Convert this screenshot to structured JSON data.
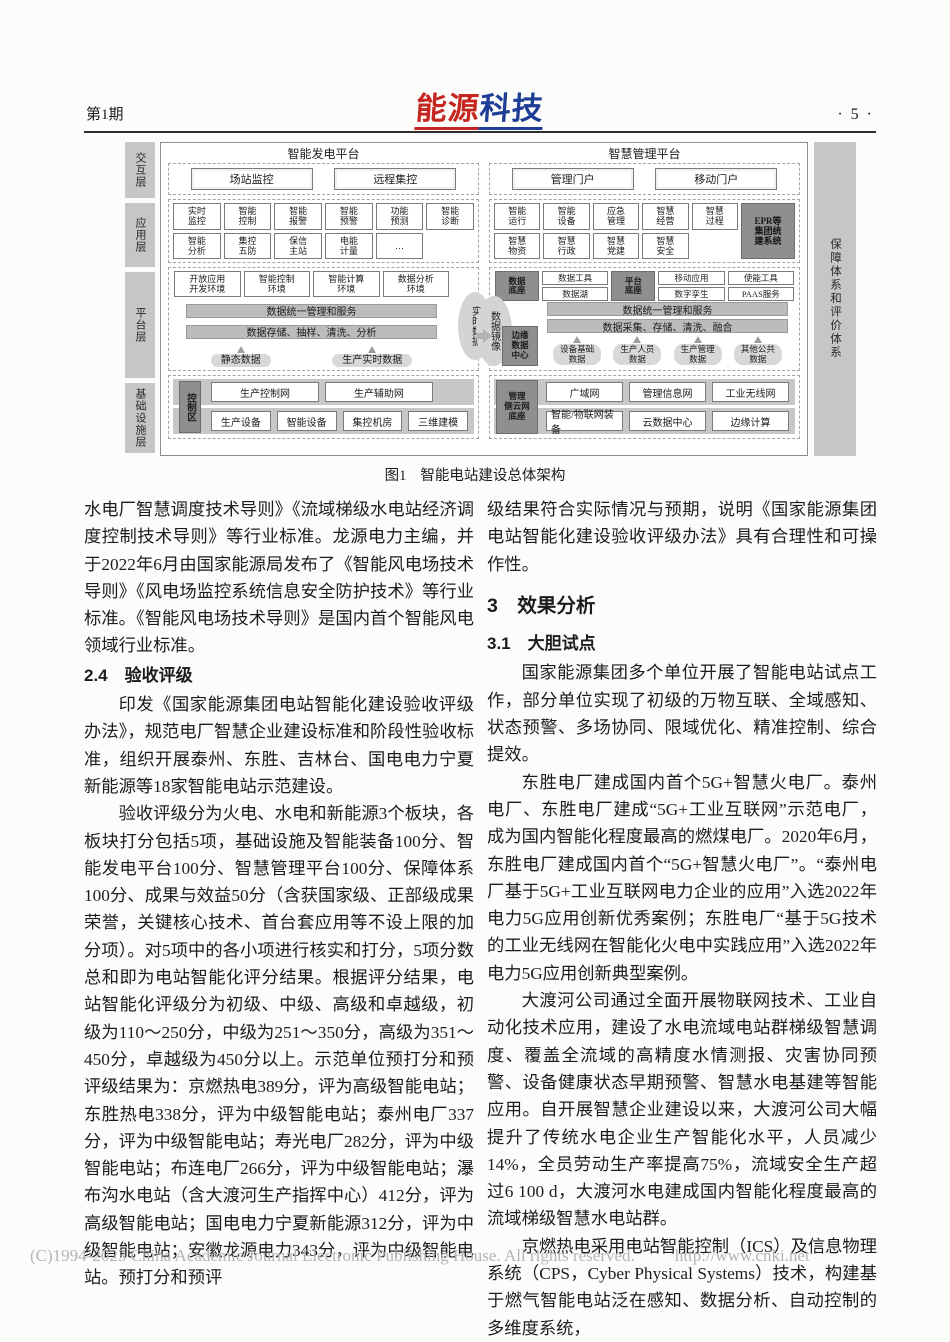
{
  "header": {
    "issue": "第1期",
    "logo_red": "能源",
    "logo_blue": "科技",
    "page_number": "· 5 ·"
  },
  "figure": {
    "caption_label": "图1",
    "caption_title": "智能电站建设总体架构",
    "layers": [
      "交互层",
      "应用层",
      "平台层",
      "基础设施层"
    ],
    "right_system_label": "保障体系和评价体系",
    "gen_platform_title": "智能发电平台",
    "mgmt_platform_title": "智慧管理平台",
    "interaction": {
      "gen": [
        "场站监控",
        "远程集控"
      ],
      "mgmt": [
        "管理门户",
        "移动门户"
      ]
    },
    "application": {
      "gen_row1": [
        "实时\n监控",
        "智能\n控制",
        "智能\n报警",
        "智能\n预警",
        "功能\n预测",
        "智能\n诊断"
      ],
      "gen_row2": [
        "智能\n分析",
        "集控\n五防",
        "保信\n主站",
        "电能\n计量",
        "…"
      ],
      "mgmt_row1": [
        "智能\n运行",
        "智能\n设备",
        "应急\n管理",
        "智慧\n经营",
        "智慧\n过程"
      ],
      "mgmt_row2": [
        "智慧\n物资",
        "智慧\n行政",
        "智慧\n党建",
        "智慧\n安全"
      ],
      "mgmt_epr": "EPR等\n集团统\n建系统"
    },
    "platform": {
      "gen_envs": [
        "开放应用\n开发环境",
        "智能控制\n环境",
        "智能计算\n环境",
        "数据分析\n环境"
      ],
      "gen_bar1": "数据统一管理和服务",
      "gen_bar2": "数据存储、抽样、清洗、分析",
      "gen_sources": [
        "静态数据",
        "生产实时数据"
      ],
      "realtime_data": "实时数据",
      "data_mirror": "数据镜像",
      "edge_center": "边缘\n数据\n中心",
      "mgmt_dark1": "数据\n底座",
      "mgmt_stack1": [
        "数据工具",
        "数据湖"
      ],
      "mgmt_dark2": "平台\n底座",
      "mgmt_stack2": [
        "移动应用",
        "数字孪生"
      ],
      "mgmt_stack3": [
        "使能工具",
        "PAAS服务"
      ],
      "mgmt_bar1": "数据统一管理和服务",
      "mgmt_bar2": "数据采集、存储、清洗、融合",
      "mgmt_sources": [
        "设备基础\n数据",
        "生产人员\n数据",
        "生产管理\n数据",
        "其他公共\n数据"
      ]
    },
    "infrastructure": {
      "gen_zone": "控制区",
      "gen_row1": [
        "生产控制网",
        "生产辅助网"
      ],
      "gen_row2": [
        "生产设备",
        "智能设备",
        "集控机房",
        "三维建模"
      ],
      "mgmt_zone": "管理\n侧云网\n底座",
      "mgmt_row1": [
        "广域网",
        "管理信息网",
        "工业无线网"
      ],
      "mgmt_row2": [
        "智能/物联网装备",
        "云数据中心",
        "边缘计算"
      ]
    }
  },
  "left_column": {
    "p1": "水电厂智慧调度技术导则》《流域梯级水电站经济调度控制技术导则》等行业标准。龙源电力主编，并于2022年6月由国家能源局发布了《智能风电场技术导则》《风电场监控系统信息安全防护技术》等行业标准。《智能风电场技术导则》是国内首个智能风电领域行业标准。",
    "h24": "2.4　验收评级",
    "p2": "印发《国家能源集团电站智能化建设验收评级办法》，规范电厂智慧企业建设标准和阶段性验收标准，组织开展泰州、东胜、吉林台、国电电力宁夏新能源等18家智能电站示范建设。",
    "p3": "验收评级分为火电、水电和新能源3个板块，各板块打分包括5项，基础设施及智能装备100分、智能发电平台100分、智慧管理平台100分、保障体系100分、成果与效益50分（含获国家级、正部级成果荣誉，关键核心技术、首台套应用等不设上限的加分项）。对5项中的各小项进行核实和打分，5项分数总和即为电站智能化评分结果。根据评分结果，电站智能化评级分为初级、中级、高级和卓越级，初级为110～250分，中级为251～350分，高级为351～450分，卓越级为450分以上。示范单位预打分和预评级结果为：京燃热电389分，评为高级智能电站；东胜热电338分，评为中级智能电站；泰州电厂337分，评为中级智能电站；寿光电厂282分，评为中级智能电站；布连电厂266分，评为中级智能电站；瀑布沟水电站（含大渡河生产指挥中心）412分，评为高级智能电站；国电电力宁夏新能源312分，评为中级智能电站；安徽龙源电力343分，评为中级智能电站。预打分和预评"
  },
  "right_column": {
    "p1": "级结果符合实际情况与预期，说明《国家能源集团电站智能化建设验收评级办法》具有合理性和可操作性。",
    "h3": "3　效果分析",
    "h31": "3.1　大胆试点",
    "p2": "国家能源集团多个单位开展了智能电站试点工作，部分单位实现了初级的万物互联、全域感知、状态预警、多场协同、限域优化、精准控制、综合提效。",
    "p3": "东胜电厂建成国内首个5G+智慧火电厂。泰州电厂、东胜电厂建成“5G+工业互联网”示范电厂，成为国内智能化程度最高的燃煤电厂。2020年6月，东胜电厂建成国内首个“5G+智慧火电厂”。“泰州电厂基于5G+工业互联网电力企业的应用”入选2022年电力5G应用创新优秀案例；东胜电厂“基于5G技术的工业无线网在智能化火电中实践应用”入选2022年电力5G应用创新典型案例。",
    "p4": "大渡河公司通过全面开展物联网技术、工业自动化技术应用，建设了水电流域电站群梯级智慧调度、覆盖全流域的高精度水情测报、灾害协同预警、设备健康状态早期预警、智慧水电基建等智能应用。自开展智慧企业建设以来，大渡河公司大幅提升了传统水电企业生产智能化水平，人员减少14%，全员劳动生产率提高75%，流域安全生产超过6 100 d，大渡河水电建成国内智能化程度最高的流域梯级智慧水电站群。",
    "p5": "京燃热电采用电站智能控制（ICS）及信息物理系统（CPS，Cyber Physical Systems）技术，构建基于燃气智能电站泛在感知、数据分析、自动控制的多维度系统，"
  },
  "footer": {
    "copyright": "(C)1994-2023 China Academic Journal Electronic Publishing House. All rights reserved.",
    "url": "http://www.cnki.net"
  }
}
